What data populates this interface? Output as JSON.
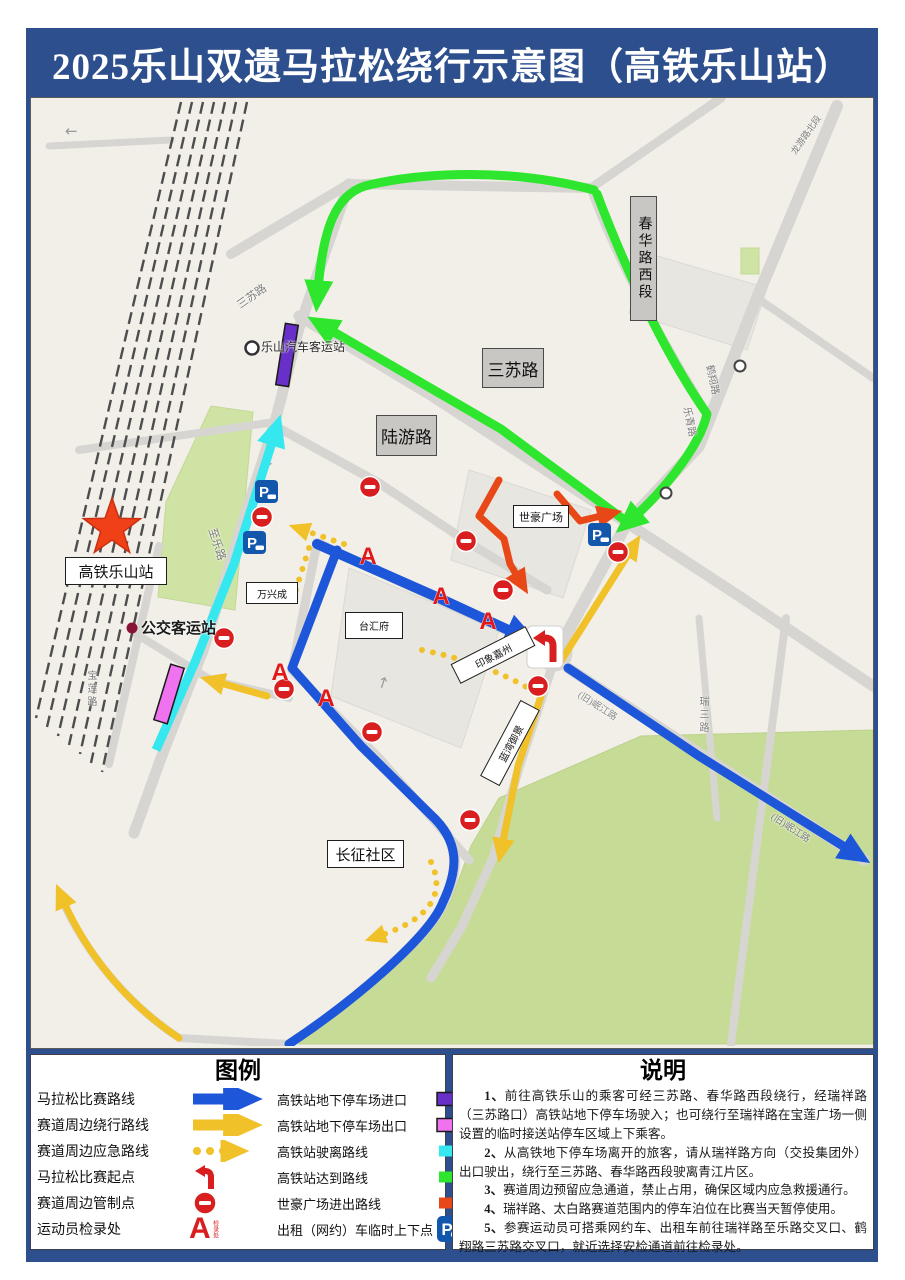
{
  "title": "2025乐山双遗马拉松绕行示意图（高铁乐山站）",
  "colors": {
    "frame_navy": "#2d4f8d",
    "marathon_blue": "#1d56d8",
    "detour_yellow": "#f0c128",
    "emergency_yellow_dotted": "#f0c128",
    "depart_cyan": "#35e7ee",
    "arrive_green": "#2ee62e",
    "shihao_orange": "#e84818",
    "entrance_purple": "#6930c9",
    "exit_magenta": "#ef72ef",
    "control_red": "#d81e1e",
    "parking_blue": "#1357ad",
    "map_bg": "#f2efe8"
  },
  "map": {
    "marker_a": "A",
    "marker_p": "P",
    "arrows": {
      "left": "←",
      "down": "↓",
      "up": "↑"
    },
    "labels": {
      "station": "高铁乐山站",
      "coach_station": "乐山汽车客运站",
      "bus_station": "公交客运站",
      "box_sansu": "三苏路",
      "box_luyou": "陆游路",
      "box_chunhua": "春华路西段",
      "box_shihao": "世豪广场",
      "box_changzheng": "长征社区",
      "box_taihui": "台汇府",
      "box_wanxing": "万兴成",
      "box_yinxiang": "印象嘉州",
      "box_lanwan": "蓝湾御景",
      "road_sansu": "三苏路",
      "road_zhile": "至乐路",
      "road_baolian": "宝莲路",
      "road_hexiang": "鹤翔路",
      "road_leqing": "乐青路",
      "road_longyou": "龙游路北段",
      "road_ruisan": "瑞三路",
      "road_minjiang1": "(旧)岷江路",
      "road_minjiang2": "(旧)岷江路"
    }
  },
  "legend": {
    "title": "图例",
    "a_side": "检录处",
    "left": [
      "马拉松比赛路线",
      "赛道周边绕行路线",
      "赛道周边应急路线",
      "马拉松比赛起点",
      "赛道周边管制点",
      "运动员检录处"
    ],
    "right": [
      "高铁站地下停车场进口",
      "高铁站地下停车场出口",
      "高铁站驶离路线",
      "高铁站达到路线",
      "世豪广场进出路线",
      "出租（网约）车临时上下点"
    ]
  },
  "notes": {
    "title": "说明",
    "items": [
      {
        "num": "1、",
        "text": "前往高铁乐山的乘客可经三苏路、春华路西段绕行，经瑞祥路（三苏路口）高铁站地下停车场驶入；也可绕行至瑞祥路在宝莲广场一侧设置的临时接送站停车区域上下乘客。"
      },
      {
        "num": "2、",
        "text": "从高铁地下停车场离开的旅客，请从瑞祥路方向（交投集团外）出口驶出，绕行至三苏路、春华路西段驶离青江片区。"
      },
      {
        "num": "3、",
        "text": "赛道周边预留应急通道，禁止占用，确保区域内应急救援通行。"
      },
      {
        "num": "4、",
        "text": "瑞祥路、太白路赛道范围内的停车泊位在比赛当天暂停使用。"
      },
      {
        "num": "5、",
        "text": "参赛运动员可搭乘网约车、出租车前往瑞祥路至乐路交叉口、鹤翔路三苏路交叉口，就近选择安检通道前往检录处。"
      }
    ]
  }
}
